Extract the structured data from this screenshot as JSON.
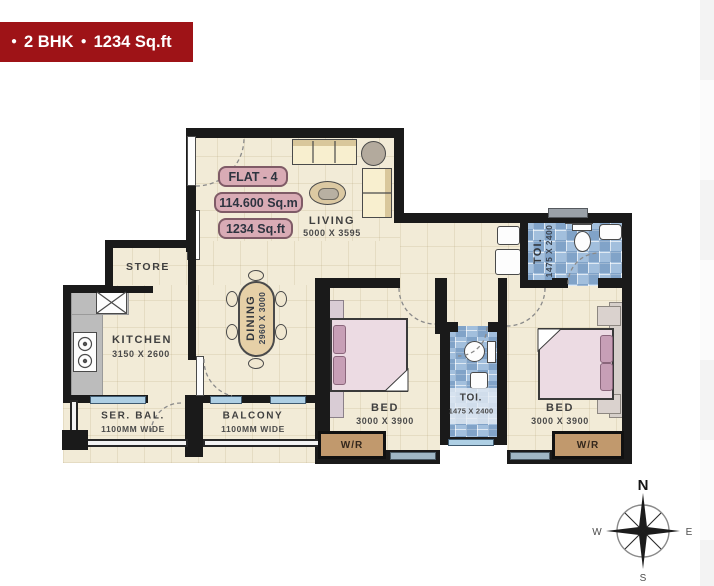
{
  "banner": {
    "bullet": "●",
    "unit_type": "2 BHK",
    "area": "1234 Sq.ft"
  },
  "flat": {
    "name": "FLAT - 4",
    "area_sqm": "114.600 Sq.m",
    "area_sqft": "1234 Sq.ft"
  },
  "rooms": {
    "living": {
      "name": "LIVING",
      "dim": "5000 X 3595"
    },
    "dining": {
      "name": "DINING",
      "dim": "2960 X 3000"
    },
    "kitchen": {
      "name": "KITCHEN",
      "dim": "3150 X 2600"
    },
    "store": {
      "name": "STORE"
    },
    "service_balcony": {
      "name": "SER. BAL.",
      "dim": "1100MM WIDE"
    },
    "balcony": {
      "name": "BALCONY",
      "dim": "1100MM WIDE"
    },
    "bed1": {
      "name": "BED",
      "dim": "3000 X 3900"
    },
    "bed2": {
      "name": "BED",
      "dim": "3000 X 3900"
    },
    "toilet_top": {
      "name": "TOI.",
      "dim": "1475 X 2400"
    },
    "toilet_mid": {
      "name": "TOI.",
      "dim": "1475 X 2400"
    },
    "wardrobe_left": {
      "name": "W/R"
    },
    "wardrobe_right": {
      "name": "W/R"
    }
  },
  "compass": {
    "north": "N",
    "east": "E",
    "south": "S",
    "west": "W"
  },
  "colors": {
    "banner_bg": "#9e1317",
    "banner_text": "#ffffff",
    "wall": "#1a1a1a",
    "floor_beige": "#f2ebd7",
    "tile_blue": "#a2bfdd",
    "label_pink_bg": "#d9abb5",
    "wardrobe_tan": "#c1996d"
  }
}
